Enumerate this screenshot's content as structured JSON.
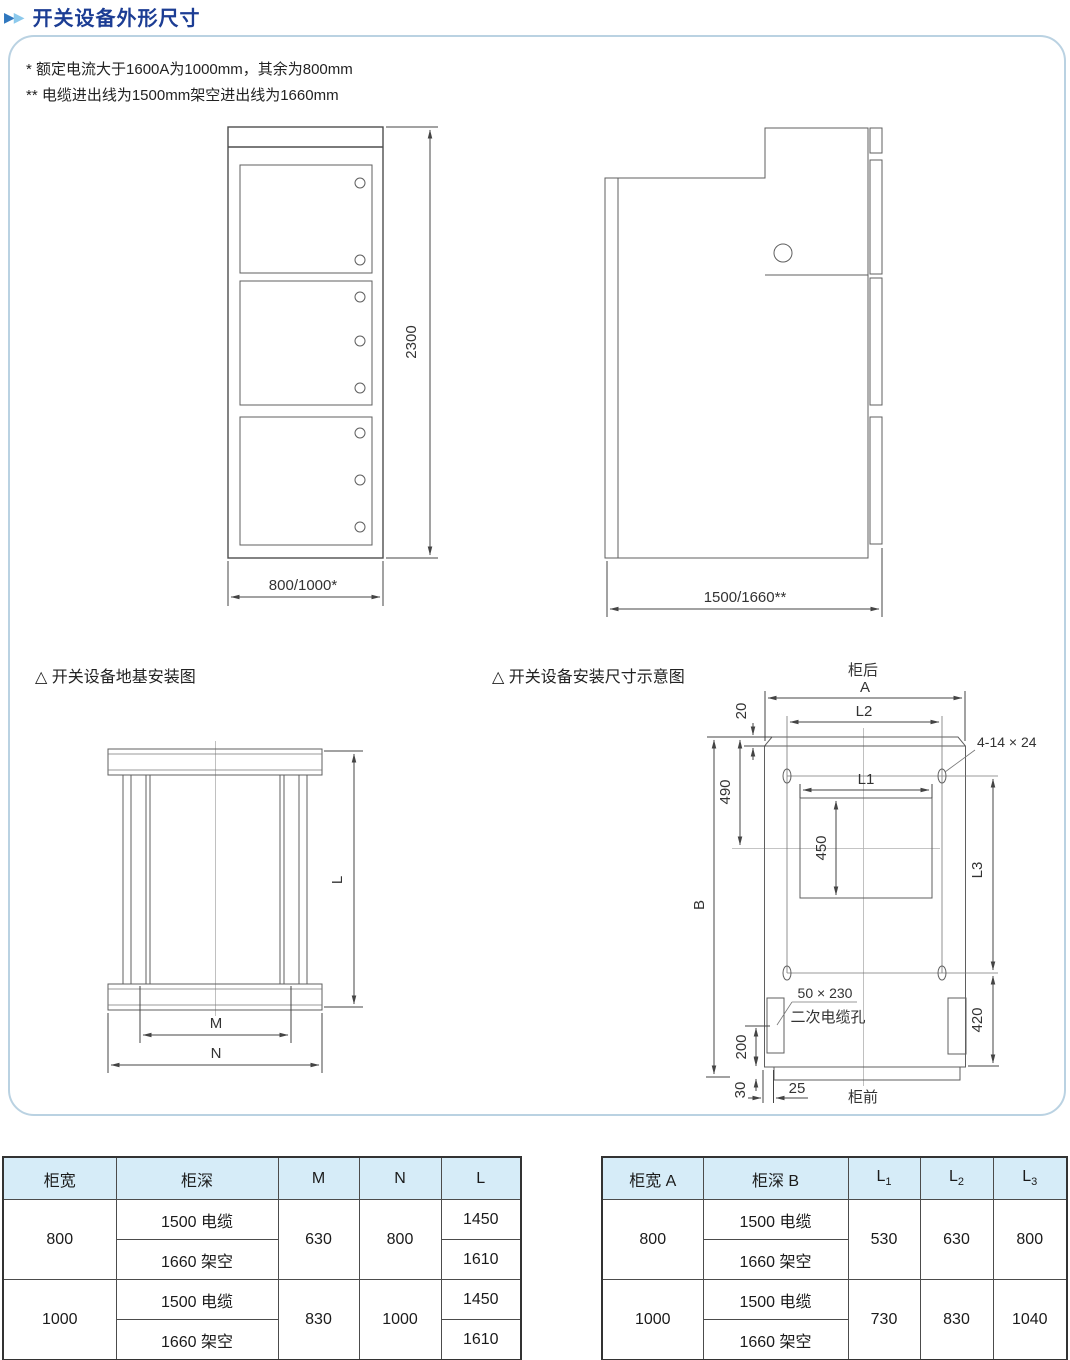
{
  "page": {
    "title": "开关设备外形尺寸",
    "marker_icon": "▶"
  },
  "panel": {
    "notes": [
      "* 额定电流大于1600A为1000mm，其余为800mm",
      "** 电缆进出线为1500mm架空进出线为1660mm"
    ]
  },
  "front_view": {
    "height_dim": "2300",
    "width_dim": "800/1000*"
  },
  "side_view": {
    "depth_dim": "1500/1660**"
  },
  "foundation": {
    "caption": "△ 开关设备地基安装图",
    "dim_l": "L",
    "dim_m": "M",
    "dim_n": "N"
  },
  "installation": {
    "caption": "△ 开关设备安装尺寸示意图",
    "rear": "柜后",
    "front": "柜前",
    "dim_a": "A",
    "dim_l1": "L1",
    "dim_l2": "L2",
    "dim_l3": "L3",
    "dim_b": "B",
    "dim_20": "20",
    "dim_490": "490",
    "dim_450": "450",
    "dim_420": "420",
    "dim_200": "200",
    "dim_30": "30",
    "dim_25": "25",
    "hole_spec": "4-14 × 24",
    "cable_hole_spec": "50 × 230",
    "cable_hole_name": "二次电缆孔"
  },
  "left_table": {
    "headers": [
      "柜宽",
      "柜深",
      "M",
      "N",
      "L"
    ],
    "groups": [
      {
        "width": "800",
        "depth_rows": [
          "1500 电缆",
          "1660 架空"
        ],
        "m": "630",
        "n": "800",
        "l_rows": [
          "1450",
          "1610"
        ]
      },
      {
        "width": "1000",
        "depth_rows": [
          "1500 电缆",
          "1660 架空"
        ],
        "m": "830",
        "n": "1000",
        "l_rows": [
          "1450",
          "1610"
        ]
      }
    ]
  },
  "right_table": {
    "headers": [
      {
        "main": "柜宽 A"
      },
      {
        "main": "柜深 B"
      },
      {
        "main": "L",
        "sub": "1"
      },
      {
        "main": "L",
        "sub": "2"
      },
      {
        "main": "L",
        "sub": "3"
      }
    ],
    "groups": [
      {
        "width": "800",
        "depth_rows": [
          "1500 电缆",
          "1660 架空"
        ],
        "l1": "530",
        "l2": "630",
        "l3": "800"
      },
      {
        "width": "1000",
        "depth_rows": [
          "1500 电缆",
          "1660 架空"
        ],
        "l1": "730",
        "l2": "830",
        "l3": "1040"
      }
    ]
  }
}
